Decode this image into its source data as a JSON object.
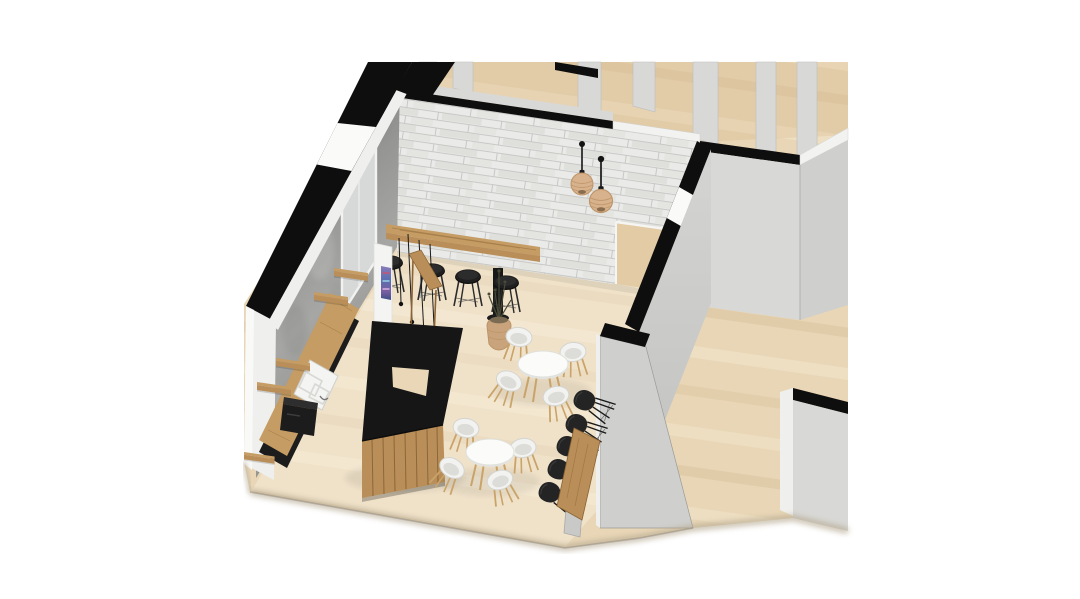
{
  "scene": {
    "type": "architectural-3d-render",
    "description": "Cutaway axonometric 3D render of a cafe interior floor plan with bar, seating and adjacent rooms",
    "projection": "axonometric cutaway; sectioned walls capped in black",
    "background": "#ffffff"
  },
  "palette": {
    "bg": "#ffffff",
    "floor_wood": "#e8d6b6",
    "floor_plank_dark": "#c7a778",
    "floor_upper_tint": "#caa06a",
    "cafe_floor_tint": "#fff8ec",
    "cut_wall_black": "#0e0e0e",
    "white_cap": "#f2f2f0",
    "brick_base": "#eaeae8",
    "brick_joint": "#c4c4c2",
    "brick_shade": "#dfdfdc",
    "concrete_light": "#b4b4b2",
    "concrete_dark": "#8c8c8a",
    "window_glass": "#d7d9d8",
    "wall_face_light": "#d8d8d6",
    "wall_face_mid": "#cfcfcd",
    "wall_face_dark": "#c5c5c3",
    "white_face": "#efefed",
    "bar_black": "#161616",
    "counter_black": "#1c1c1c",
    "wood_light": "#c59c63",
    "wood_mid": "#b98e58",
    "wood_dark": "#8a6233",
    "wood_plank_line": "#7d5a2e",
    "steel": "#b9b9b7",
    "white_chair": "#f2f2f0",
    "white_chair_shade": "#dcdcd8",
    "chair_leg": "#c9a36a",
    "black_chair": "#242424",
    "stool_black": "#1f1f1f",
    "rattan": "#d8b28c",
    "rattan_dark": "#bd9468",
    "plant_green": "#4a4a38",
    "pot_tan": "#c9a37b",
    "fridge_a": "#6f5fa8",
    "fridge_b": "#4a6fb5",
    "sink_white": "#f4f4f2",
    "shadow_soft": "#b5a890",
    "shadow_line": "#8a8177"
  },
  "rooms": [
    {
      "name": "cafe",
      "floor": "light oak planks"
    },
    {
      "name": "adjacent-rooms",
      "floor": "light oak planks"
    },
    {
      "name": "corridor",
      "floor": "light oak planks"
    }
  ],
  "objects": {
    "walls": [
      {
        "name": "exterior-wall",
        "material": "raw concrete",
        "features": [
          "window"
        ],
        "cut_cap": "black"
      },
      {
        "name": "feature-wall",
        "material": "white painted brick",
        "features": [
          "door-opening"
        ],
        "cut_cap": "black"
      },
      {
        "name": "partition-walls",
        "material": "light grey plaster",
        "count": 6,
        "cut_cap": "black"
      },
      {
        "name": "wall-columns",
        "count": 6
      }
    ],
    "furniture": [
      {
        "name": "bar-counter",
        "style": "Z-shaped, black top, rustic timber plank front"
      },
      {
        "name": "back-counter",
        "style": "timber worktop on black base",
        "equipment": [
          "double-sink",
          "espresso-machine"
        ]
      },
      {
        "name": "wall-shelves",
        "count": 5,
        "material": "timber"
      },
      {
        "name": "high-bar-table",
        "material": "timber",
        "seating": "4 black stools"
      },
      {
        "name": "console-high-table",
        "material": "timber"
      },
      {
        "name": "round-table",
        "count": 2,
        "top": "white",
        "seating": "4 white shell chairs each, timber legs"
      },
      {
        "name": "communal-table",
        "material": "timber",
        "seating": "5 black shell chairs"
      }
    ],
    "lighting": [
      {
        "name": "rattan-pendant-lamp",
        "count": 2
      },
      {
        "name": "cord-pendant-bulbs",
        "count": 4
      }
    ],
    "decor": [
      {
        "name": "potted-plant",
        "pot": "rattan basket"
      },
      {
        "name": "drinks-fridge",
        "accent": "purple-blue"
      }
    ]
  }
}
